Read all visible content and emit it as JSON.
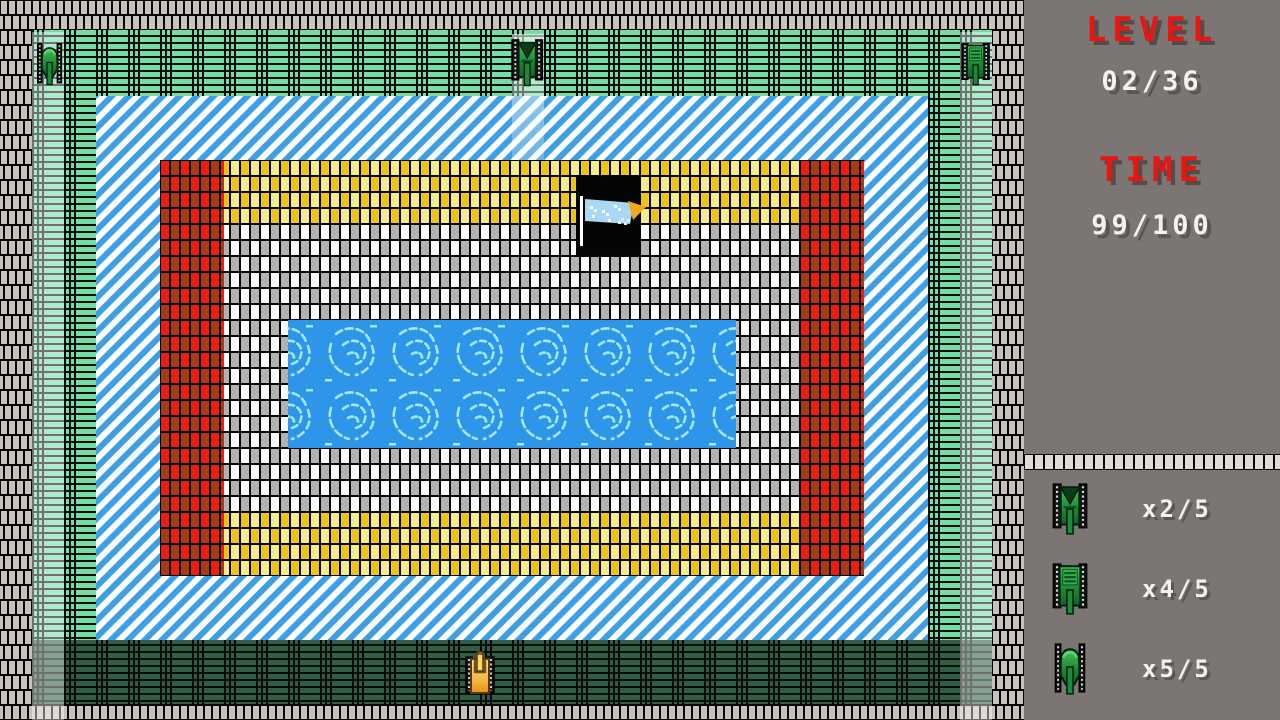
{
  "hud": {
    "level_label": "LEVEL",
    "level_value": "02/36",
    "time_label": "TIME",
    "time_value": "99/100",
    "reserves": [
      {
        "icon": "tank-class-1-icon",
        "count": "x2/5"
      },
      {
        "icon": "tank-class-2-icon",
        "count": "x4/5"
      },
      {
        "icon": "tank-class-3-icon",
        "count": "x5/5"
      }
    ],
    "colors": {
      "panel_gray": "#7b7673",
      "label_red": "#ea1411",
      "value_white": "#f4f2f0"
    }
  },
  "game": {
    "entities": {
      "enemy_tanks": [
        {
          "type": "tank-class-3",
          "position": "top-left-lane",
          "facing": "down",
          "color": "green"
        },
        {
          "type": "tank-class-1",
          "position": "top-center-lane",
          "facing": "down",
          "color": "green"
        },
        {
          "type": "tank-class-2",
          "position": "top-right-lane",
          "facing": "down",
          "color": "green"
        }
      ],
      "player_tank": {
        "position": "bottom-center",
        "facing": "up",
        "color": "orange"
      },
      "flag": {
        "position": "top-of-fort",
        "banner_color": "#a9d8f4",
        "tip_color": "#f3a81c"
      },
      "spawn_lanes": [
        "left",
        "center",
        "right"
      ]
    },
    "terrain_colors": {
      "wall_gray": "#c6c2be",
      "hedge_mint": "#74dda4",
      "hedge_dark": "#2e5e44",
      "ice_blue": "#3f9fe2",
      "water_blue": "#2e96e9",
      "water_wave": "#a5e6f8",
      "brick_red": [
        "#e9200f",
        "#a63b15"
      ],
      "brick_yellow": [
        "#eec41b",
        "#f4ea8e"
      ],
      "brick_light": [
        "#ffffff",
        "#b4b1b1"
      ]
    }
  }
}
